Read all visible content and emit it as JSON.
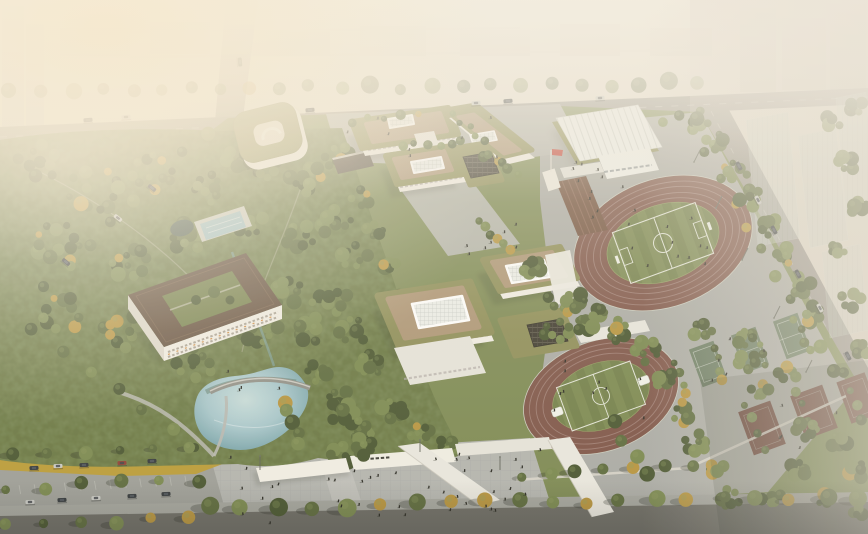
{
  "palette": {
    "sky": "#e7e0d3",
    "hazeWarm": "#f5ecdc",
    "city": "#c2bcae",
    "cityDark": "#b3ac9e",
    "road": "#98948c",
    "roadDark": "#6b6a63",
    "sidewalk": "#a3a49d",
    "parkBase": "#7a8750",
    "forestDark": "#46532d",
    "forestMid": "#5a683a",
    "forestLight": "#77864c",
    "autumn": "#b5923b",
    "ochre": "#b99a35",
    "ochreLight": "#c9ad42",
    "ochreDark": "#8f7d2f",
    "facade": "#f0ede4",
    "facadeShade": "#ddd8cc",
    "paving": "#b0b1aa",
    "sportPaving": "#a9aaa4",
    "roofOlive": "#8b8b54",
    "roofTan": "#ab9372",
    "roofBrown": "#5e4937",
    "skylight": "#eceeea",
    "solar": "#3b372c",
    "trackRed": "#7c5245",
    "trackLine": "#a5867c",
    "fieldGreen": "#6f7d46",
    "fieldStripe": "#78864d",
    "courtGreen": "#67795f",
    "courtRed": "#6b4035",
    "pond": "#a6c6cb",
    "pondDeep": "#76a0a6",
    "plaza": "#b2b3ae",
    "ghostTower": "#cdd5cc",
    "flagRed": "#c23a2e",
    "bleacher": "#6e4c38",
    "gymRib": "#d7d8d3",
    "people": "#26261f",
    "carDark": "#2f3438",
    "carLight": "#c8c9c4",
    "carRed": "#8e3c30",
    "white": "#ffffff"
  },
  "scene": {
    "treeRows": [
      [
        12,
        92,
        700,
        83,
        24,
        7,
        "LBack",
        0
      ],
      [
        208,
        508,
        860,
        496,
        20,
        7.5,
        "LFront",
        1
      ],
      [
        8,
        526,
        186,
        517,
        6,
        6,
        "LFront",
        1
      ],
      [
        12,
        456,
        192,
        446,
        6,
        5.5,
        "LFront",
        1
      ],
      [
        8,
        490,
        198,
        479,
        6,
        5.5,
        "LFront",
        1
      ],
      [
        692,
        128,
        836,
        372,
        11,
        5.5,
        "LMid",
        0
      ],
      [
        712,
        347,
        724,
        380,
        4,
        4.2,
        "LMid",
        0
      ],
      [
        754,
        333,
        766,
        366,
        4,
        4.2,
        "LMid",
        0
      ],
      [
        796,
        319,
        808,
        352,
        4,
        4.2,
        "LMid",
        0
      ],
      [
        676,
        361,
        688,
        394,
        4,
        4.2,
        "LMid",
        0
      ],
      [
        747,
        406,
        762,
        448,
        4,
        4.5,
        "LMid",
        0
      ],
      [
        798,
        390,
        813,
        432,
        4,
        4.5,
        "LMid",
        0
      ],
      [
        846,
        375,
        861,
        417,
        4,
        4.5,
        "LMid",
        0
      ],
      [
        522,
        477,
        690,
        465,
        7,
        6,
        "LMid",
        1
      ],
      [
        402,
        147,
        462,
        141,
        6,
        4.3,
        "LMid",
        0
      ],
      [
        482,
        154,
        516,
        172,
        6,
        4.5,
        "LMid",
        0
      ],
      [
        478,
        222,
        512,
        250,
        6,
        4.8,
        "LMid",
        0
      ],
      [
        452,
        116,
        486,
        140,
        5,
        4,
        "LMid",
        0
      ],
      [
        546,
        300,
        576,
        318,
        5,
        4.5,
        "LMid",
        0
      ],
      [
        286,
        402,
        300,
        446,
        5,
        6,
        "LMid",
        0
      ],
      [
        206,
        132,
        44,
        288,
        8,
        6,
        "LMid",
        0
      ],
      [
        34,
        332,
        198,
        448,
        7,
        5,
        "LMid",
        0
      ],
      [
        352,
        122,
        420,
        114,
        5,
        4,
        "LMid",
        0
      ],
      [
        664,
        120,
        700,
        112,
        3,
        4.5,
        "LMid",
        0
      ],
      [
        612,
        424,
        650,
        474,
        4,
        6,
        "LMid",
        0
      ]
    ],
    "treeClusters": [
      [
        40,
        162,
        26,
        10,
        "LForest"
      ],
      [
        95,
        190,
        30,
        12,
        "LForest"
      ],
      [
        152,
        172,
        26,
        10,
        "LForest"
      ],
      [
        210,
        188,
        22,
        9,
        "LForest"
      ],
      [
        262,
        170,
        20,
        8,
        "LForest"
      ],
      [
        305,
        182,
        24,
        10,
        "LForest"
      ],
      [
        336,
        156,
        16,
        7,
        "LForest"
      ],
      [
        238,
        160,
        14,
        6,
        "LForest"
      ],
      [
        60,
        242,
        30,
        12,
        "LForest"
      ],
      [
        128,
        262,
        28,
        11,
        "LForest"
      ],
      [
        185,
        238,
        20,
        8,
        "LForest"
      ],
      [
        250,
        226,
        18,
        8,
        "LForest"
      ],
      [
        300,
        238,
        20,
        8,
        "LForest"
      ],
      [
        335,
        222,
        18,
        8,
        "LForest"
      ],
      [
        355,
        256,
        16,
        7,
        "LForest"
      ],
      [
        62,
        312,
        26,
        10,
        "LForest"
      ],
      [
        122,
        332,
        26,
        10,
        "LForest"
      ],
      [
        170,
        302,
        18,
        8,
        "LForest"
      ],
      [
        232,
        282,
        18,
        8,
        "LForest"
      ],
      [
        286,
        290,
        20,
        8,
        "LForest"
      ],
      [
        330,
        300,
        20,
        8,
        "LForest"
      ],
      [
        196,
        362,
        22,
        9,
        "LForest"
      ],
      [
        258,
        334,
        24,
        10,
        "LForest"
      ],
      [
        310,
        330,
        18,
        8,
        "LForest"
      ],
      [
        352,
        332,
        18,
        8,
        "LForest"
      ],
      [
        370,
        366,
        18,
        8,
        "LForest"
      ],
      [
        318,
        372,
        14,
        6,
        "LForest"
      ],
      [
        340,
        402,
        16,
        7,
        "LForest"
      ],
      [
        366,
        434,
        16,
        7,
        "LForest"
      ],
      [
        342,
        456,
        14,
        6,
        "LForest"
      ],
      [
        394,
        410,
        16,
        7,
        "LForest"
      ],
      [
        420,
        434,
        14,
        6,
        "LForest"
      ],
      [
        448,
        446,
        12,
        6,
        "LForest"
      ],
      [
        398,
        300,
        12,
        5,
        "LForest"
      ],
      [
        388,
        266,
        12,
        5,
        "LForest"
      ],
      [
        376,
        232,
        12,
        5,
        "LForest"
      ],
      [
        362,
        198,
        12,
        5,
        "LForest"
      ],
      [
        530,
        268,
        14,
        7,
        "LMid"
      ],
      [
        556,
        330,
        15,
        7,
        "LMid"
      ],
      [
        586,
        322,
        13,
        6,
        "LMid"
      ],
      [
        618,
        330,
        15,
        7,
        "LMid"
      ],
      [
        648,
        352,
        15,
        7,
        "LMid"
      ],
      [
        666,
        382,
        15,
        7,
        "LMid"
      ],
      [
        682,
        412,
        15,
        7,
        "LMid"
      ],
      [
        698,
        442,
        15,
        7,
        "LMid"
      ],
      [
        714,
        470,
        14,
        6,
        "LMid"
      ],
      [
        730,
        498,
        13,
        6,
        "LMid"
      ],
      [
        748,
        362,
        12,
        5,
        "LMid"
      ],
      [
        702,
        330,
        11,
        5,
        "LMid"
      ],
      [
        760,
        392,
        12,
        5,
        "LMid"
      ],
      [
        788,
        372,
        11,
        5,
        "LMid"
      ],
      [
        806,
        430,
        12,
        5,
        "LMid"
      ],
      [
        840,
        442,
        12,
        5,
        "LMid"
      ],
      [
        858,
        470,
        12,
        5,
        "LMid"
      ],
      [
        800,
        470,
        12,
        5,
        "LMid"
      ],
      [
        772,
        500,
        12,
        5,
        "LMid"
      ],
      [
        828,
        500,
        12,
        5,
        "LMid"
      ],
      [
        856,
        512,
        10,
        4,
        "LMid"
      ],
      [
        744,
        338,
        10,
        5,
        "LMid"
      ],
      [
        718,
        142,
        14,
        6,
        "LMid"
      ],
      [
        736,
        170,
        14,
        6,
        "LMid"
      ],
      [
        752,
        198,
        14,
        6,
        "LMid"
      ],
      [
        768,
        226,
        14,
        6,
        "LMid"
      ],
      [
        784,
        256,
        13,
        6,
        "LMid"
      ],
      [
        800,
        286,
        13,
        6,
        "LMid"
      ],
      [
        814,
        314,
        12,
        5,
        "LMid"
      ],
      [
        700,
        122,
        11,
        5,
        "LMid"
      ],
      [
        836,
        250,
        12,
        5,
        "LMid"
      ],
      [
        850,
        300,
        12,
        5,
        "LMid"
      ],
      [
        858,
        206,
        12,
        5,
        "LMid"
      ],
      [
        846,
        162,
        12,
        5,
        "LMid"
      ],
      [
        830,
        122,
        12,
        5,
        "LMid"
      ],
      [
        858,
        108,
        10,
        4,
        "LMid"
      ],
      [
        862,
        350,
        10,
        5,
        "LMid"
      ],
      [
        346,
        416,
        16,
        8,
        "LMid"
      ],
      [
        362,
        446,
        14,
        7,
        "LMid"
      ],
      [
        575,
        300,
        12,
        6,
        "LMid"
      ],
      [
        600,
        312,
        10,
        5,
        "LMid"
      ]
    ],
    "people": [
      [
        210,
        452,
        300,
        72,
        26
      ],
      [
        330,
        468,
        70,
        58,
        8
      ],
      [
        612,
        200,
        95,
        75,
        12
      ],
      [
        552,
        358,
        95,
        62,
        10
      ],
      [
        466,
        212,
        52,
        42,
        7
      ],
      [
        556,
        158,
        70,
        28,
        6
      ],
      [
        338,
        114,
        180,
        42,
        8
      ],
      [
        688,
        332,
        140,
        50,
        5
      ],
      [
        742,
        398,
        118,
        58,
        5
      ],
      [
        224,
        368,
        84,
        24,
        4
      ],
      [
        462,
        448,
        96,
        52,
        8
      ],
      [
        586,
        180,
        60,
        40,
        5
      ]
    ],
    "cars": [
      [
        88,
        120,
        -4,
        "carDark"
      ],
      [
        126,
        117,
        -4,
        "carLight"
      ],
      [
        310,
        110,
        -4,
        "carDark"
      ],
      [
        476,
        103,
        -4,
        "carLight"
      ],
      [
        508,
        101,
        -4,
        "carDark"
      ],
      [
        600,
        98,
        -4,
        "carLight"
      ],
      [
        240,
        62,
        85,
        "carDark"
      ],
      [
        152,
        188,
        38,
        "carDark"
      ],
      [
        118,
        218,
        38,
        "carLight"
      ],
      [
        66,
        262,
        40,
        "carDark"
      ],
      [
        739,
        166,
        62,
        "carDark"
      ],
      [
        758,
        200,
        62,
        "carLight"
      ],
      [
        774,
        230,
        62,
        "carDark"
      ],
      [
        798,
        274,
        62,
        "carDark"
      ],
      [
        820,
        308,
        62,
        "carLight"
      ],
      [
        848,
        356,
        62,
        "carDark"
      ],
      [
        34,
        468,
        -3,
        "carDark"
      ],
      [
        58,
        466,
        -3,
        "carLight"
      ],
      [
        84,
        465,
        -3,
        "carDark"
      ],
      [
        122,
        463,
        -3,
        "carRed"
      ],
      [
        152,
        461,
        -3,
        "carDark"
      ],
      [
        30,
        502,
        -3,
        "carLight"
      ],
      [
        62,
        500,
        -3,
        "carDark"
      ],
      [
        96,
        498,
        -3,
        "carLight"
      ],
      [
        132,
        496,
        -3,
        "carDark"
      ],
      [
        166,
        494,
        -3,
        "carDark"
      ]
    ],
    "stalls": [
      [
        8,
        452,
        196,
        442,
        13,
        9,
        80
      ],
      [
        4,
        486,
        200,
        475,
        13,
        9,
        80
      ]
    ],
    "poles": [
      [
        700,
        150,
        694,
        162
      ],
      [
        722,
        196,
        716,
        208
      ],
      [
        748,
        248,
        742,
        260
      ],
      [
        780,
        306,
        774,
        318
      ],
      [
        812,
        360,
        806,
        372
      ],
      [
        260,
        470,
        260,
        456
      ],
      [
        420,
        452,
        420,
        440
      ],
      [
        500,
        470,
        500,
        457
      ]
    ]
  },
  "sign": {
    "marks": 6
  }
}
